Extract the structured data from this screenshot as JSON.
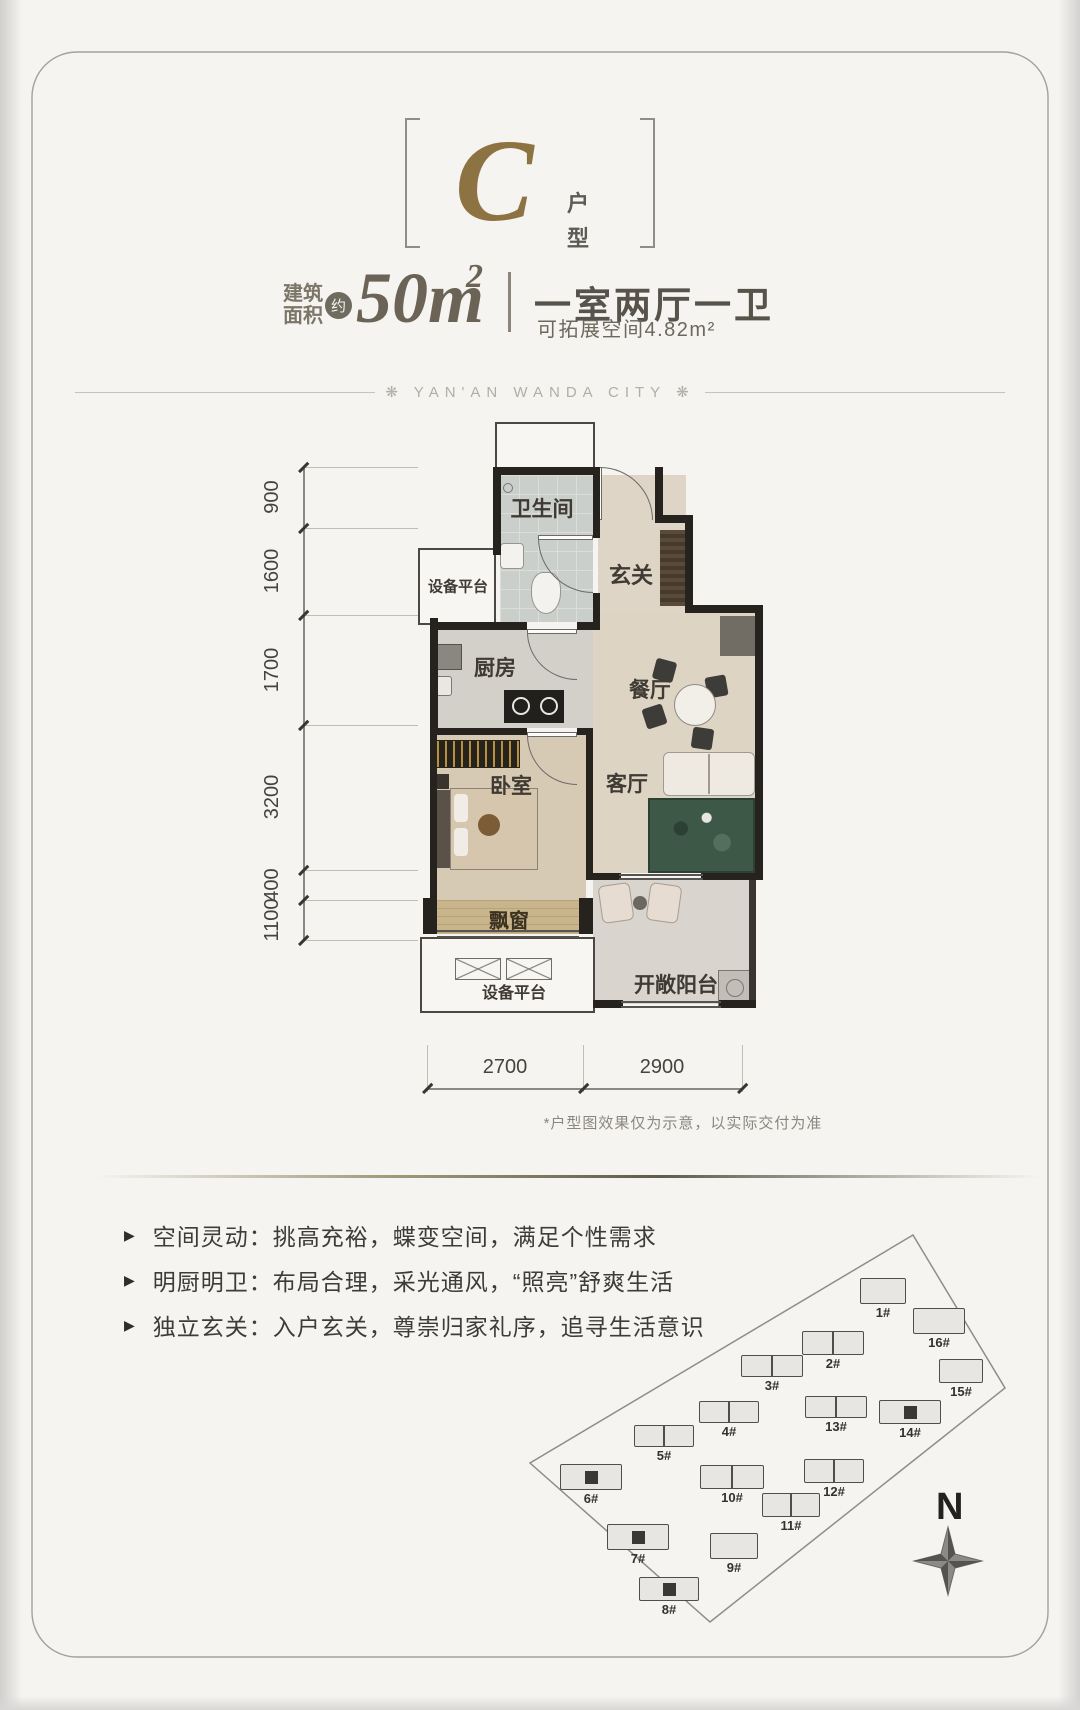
{
  "header": {
    "unit_letter": "C",
    "unit_type_vertical": [
      "户",
      "型"
    ],
    "area": {
      "prefix_line1": "建筑",
      "prefix_line2": "面积",
      "approx": "约",
      "value": "50m",
      "sup": "2",
      "layout": "一室两厅一卫",
      "expandable": "可拓展空间4.82m²"
    },
    "brand": "❋ YAN'AN WANDA CITY ❋"
  },
  "floorplan": {
    "labels": {
      "bathroom": "卫生间",
      "foyer": "玄关",
      "kitchen": "厨房",
      "dining": "餐厅",
      "living": "客厅",
      "bedroom": "卧室",
      "bay_window": "飘窗",
      "equipment_platform_top": "设备平台",
      "equipment_platform_bottom": "设备平台",
      "balcony": "开敞阳台"
    },
    "dims_left": [
      "900",
      "1600",
      "1700",
      "3200",
      "400",
      "1100"
    ],
    "dims_bottom": [
      "2700",
      "2900"
    ],
    "disclaimer": "*户型图效果仅为示意，以实际交付为准"
  },
  "features": [
    {
      "marker": "▶",
      "text": "空间灵动：挑高充裕，蝶变空间，满足个性需求"
    },
    {
      "marker": "▶",
      "text": "明厨明卫：布局合理，采光通风，“照亮”舒爽生活"
    },
    {
      "marker": "▶",
      "text": "独立玄关：入户玄关，尊崇归家礼序，追寻生活意识"
    }
  ],
  "sitemap": {
    "compass_label": "N",
    "buildings": [
      {
        "id": "1#",
        "x": 883,
        "y": 1291,
        "w": 46,
        "h": 26,
        "double": false,
        "highlighted": false
      },
      {
        "id": "16#",
        "x": 939,
        "y": 1321,
        "w": 52,
        "h": 26,
        "double": false,
        "highlighted": false
      },
      {
        "id": "2#",
        "x": 833,
        "y": 1343,
        "w": 62,
        "h": 24,
        "double": true,
        "highlighted": false
      },
      {
        "id": "3#",
        "x": 772,
        "y": 1366,
        "w": 62,
        "h": 22,
        "double": true,
        "highlighted": false
      },
      {
        "id": "15#",
        "x": 961,
        "y": 1371,
        "w": 44,
        "h": 24,
        "double": false,
        "highlighted": false
      },
      {
        "id": "4#",
        "x": 729,
        "y": 1412,
        "w": 60,
        "h": 22,
        "double": true,
        "highlighted": false
      },
      {
        "id": "13#",
        "x": 836,
        "y": 1407,
        "w": 62,
        "h": 22,
        "double": true,
        "highlighted": false
      },
      {
        "id": "14#",
        "x": 910,
        "y": 1412,
        "w": 62,
        "h": 24,
        "double": true,
        "highlighted": true
      },
      {
        "id": "5#",
        "x": 664,
        "y": 1436,
        "w": 60,
        "h": 22,
        "double": true,
        "highlighted": false
      },
      {
        "id": "6#",
        "x": 591,
        "y": 1477,
        "w": 62,
        "h": 26,
        "double": true,
        "highlighted": true
      },
      {
        "id": "10#",
        "x": 732,
        "y": 1477,
        "w": 64,
        "h": 24,
        "double": true,
        "highlighted": false
      },
      {
        "id": "12#",
        "x": 834,
        "y": 1471,
        "w": 60,
        "h": 24,
        "double": true,
        "highlighted": false
      },
      {
        "id": "11#",
        "x": 791,
        "y": 1505,
        "w": 58,
        "h": 24,
        "double": true,
        "highlighted": false
      },
      {
        "id": "7#",
        "x": 638,
        "y": 1537,
        "w": 62,
        "h": 26,
        "double": true,
        "highlighted": true
      },
      {
        "id": "9#",
        "x": 734,
        "y": 1546,
        "w": 48,
        "h": 26,
        "double": false,
        "highlighted": false
      },
      {
        "id": "8#",
        "x": 669,
        "y": 1589,
        "w": 60,
        "h": 24,
        "double": true,
        "highlighted": true
      }
    ]
  },
  "colors": {
    "gold": "#8e7342",
    "wall": "#26221e",
    "divider": "#5e5c4a"
  }
}
